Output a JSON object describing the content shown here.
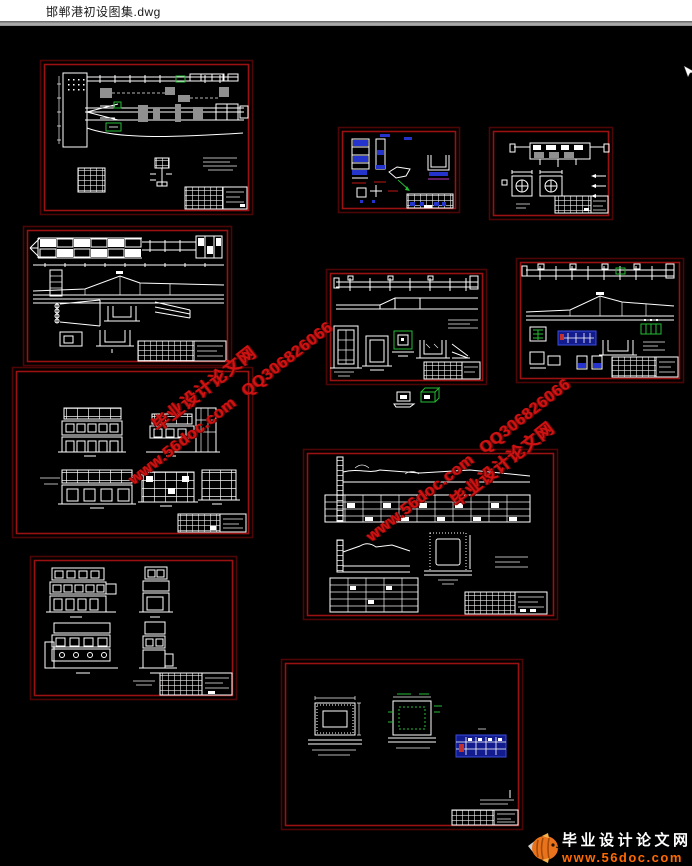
{
  "window": {
    "title": "邯郸港初设图集.dwg"
  },
  "watermark": {
    "site_name": "毕业设计论文网",
    "url": "www.56doc.com",
    "qq": "QQ306826066"
  },
  "logo": {
    "site_name": "毕业设计论文网",
    "url": "www.56doc.com"
  },
  "colors": {
    "border_outer": "#4d0505",
    "border_inner": "#9b1111",
    "wm_red": "#cf1212",
    "cad_blue": "#2333cc",
    "cad_green": "#25bb33",
    "logo_orange": "#ff6a00"
  }
}
